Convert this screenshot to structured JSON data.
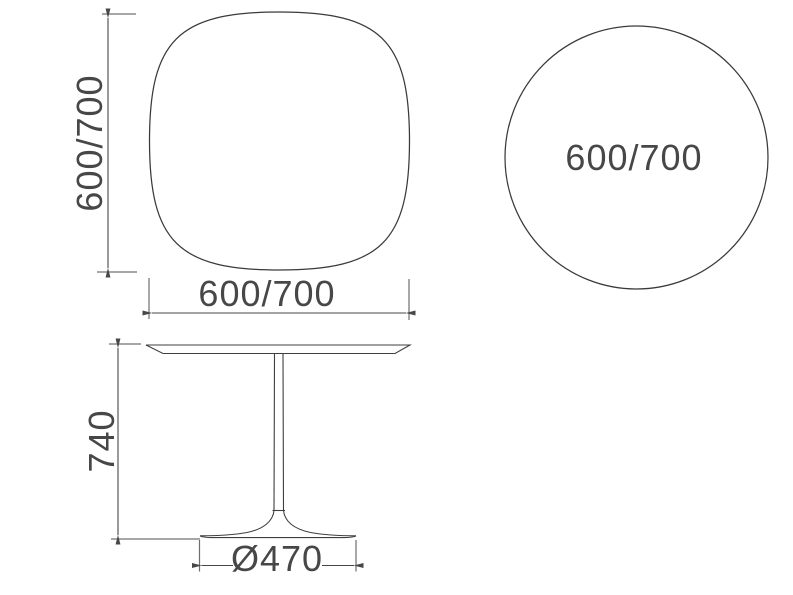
{
  "figure": {
    "type": "furniture-dimension-drawing",
    "views": {
      "square_top": {
        "height_label": "600/700",
        "width_label": "600/700"
      },
      "round_top": {
        "diameter_label": "600/700"
      },
      "side_elevation": {
        "height_label": "740",
        "base_diameter_label": "Ø470"
      }
    },
    "colors": {
      "background": "#ffffff",
      "outline": "#3a3a3a",
      "dimension_line": "#474747",
      "extension_line": "#8a8a8a",
      "text": "#474747"
    }
  }
}
